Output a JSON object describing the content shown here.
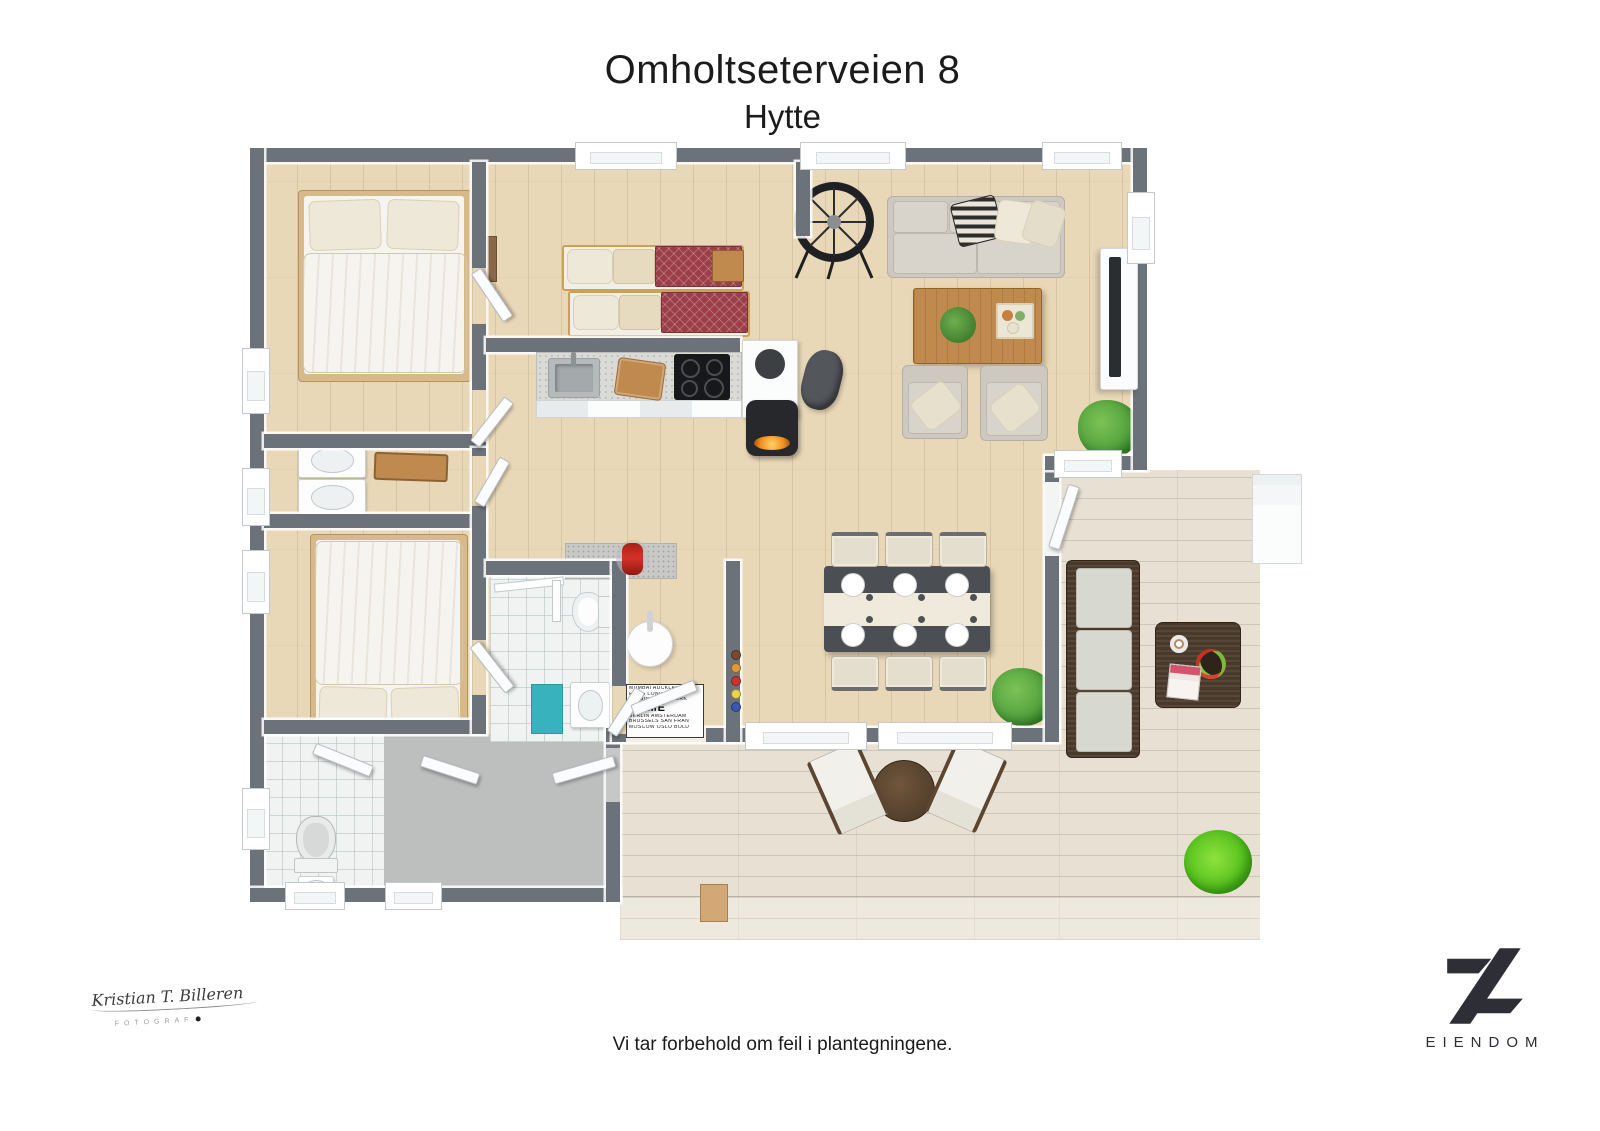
{
  "header": {
    "title": "Omholtseterveien 8",
    "subtitle": "Hytte"
  },
  "footer": {
    "disclaimer": "Vi tar forbehold om feil i plantegningene."
  },
  "watermark": {
    "signature": "Kristian T. Billeren",
    "role": "FOTOGRAF"
  },
  "brand": {
    "name": "EIENDOM"
  },
  "floorplan": {
    "doormat": {
      "word": "HOME",
      "rows": [
        "MUMBAI AUCKLAND",
        "PARIS LONDON",
        "HELSINKI NEW YORK",
        "BERLIN AMSTERDAM",
        "BRUSSELS SAN FRAN",
        "MOSCOW OSLO BOLD"
      ]
    }
  },
  "colors": {
    "wall": "#6c727a",
    "wood": "#e9d8b8",
    "deck": "#e8e1d3",
    "tile": "#f1f3f3",
    "utility": "#bdbebe",
    "red": "#d53127",
    "teal": "#38b2bd",
    "plant": "#4e9d3a",
    "grass": "#5ac320",
    "sofa": "#cdc9c1",
    "wicker": "#49392a",
    "wood_furn": "#c08a4e",
    "dining": "#4b4f54",
    "bed_red": "#9c3e47",
    "frame_wood": "#d8b98a",
    "brand": "#2e2e37"
  }
}
